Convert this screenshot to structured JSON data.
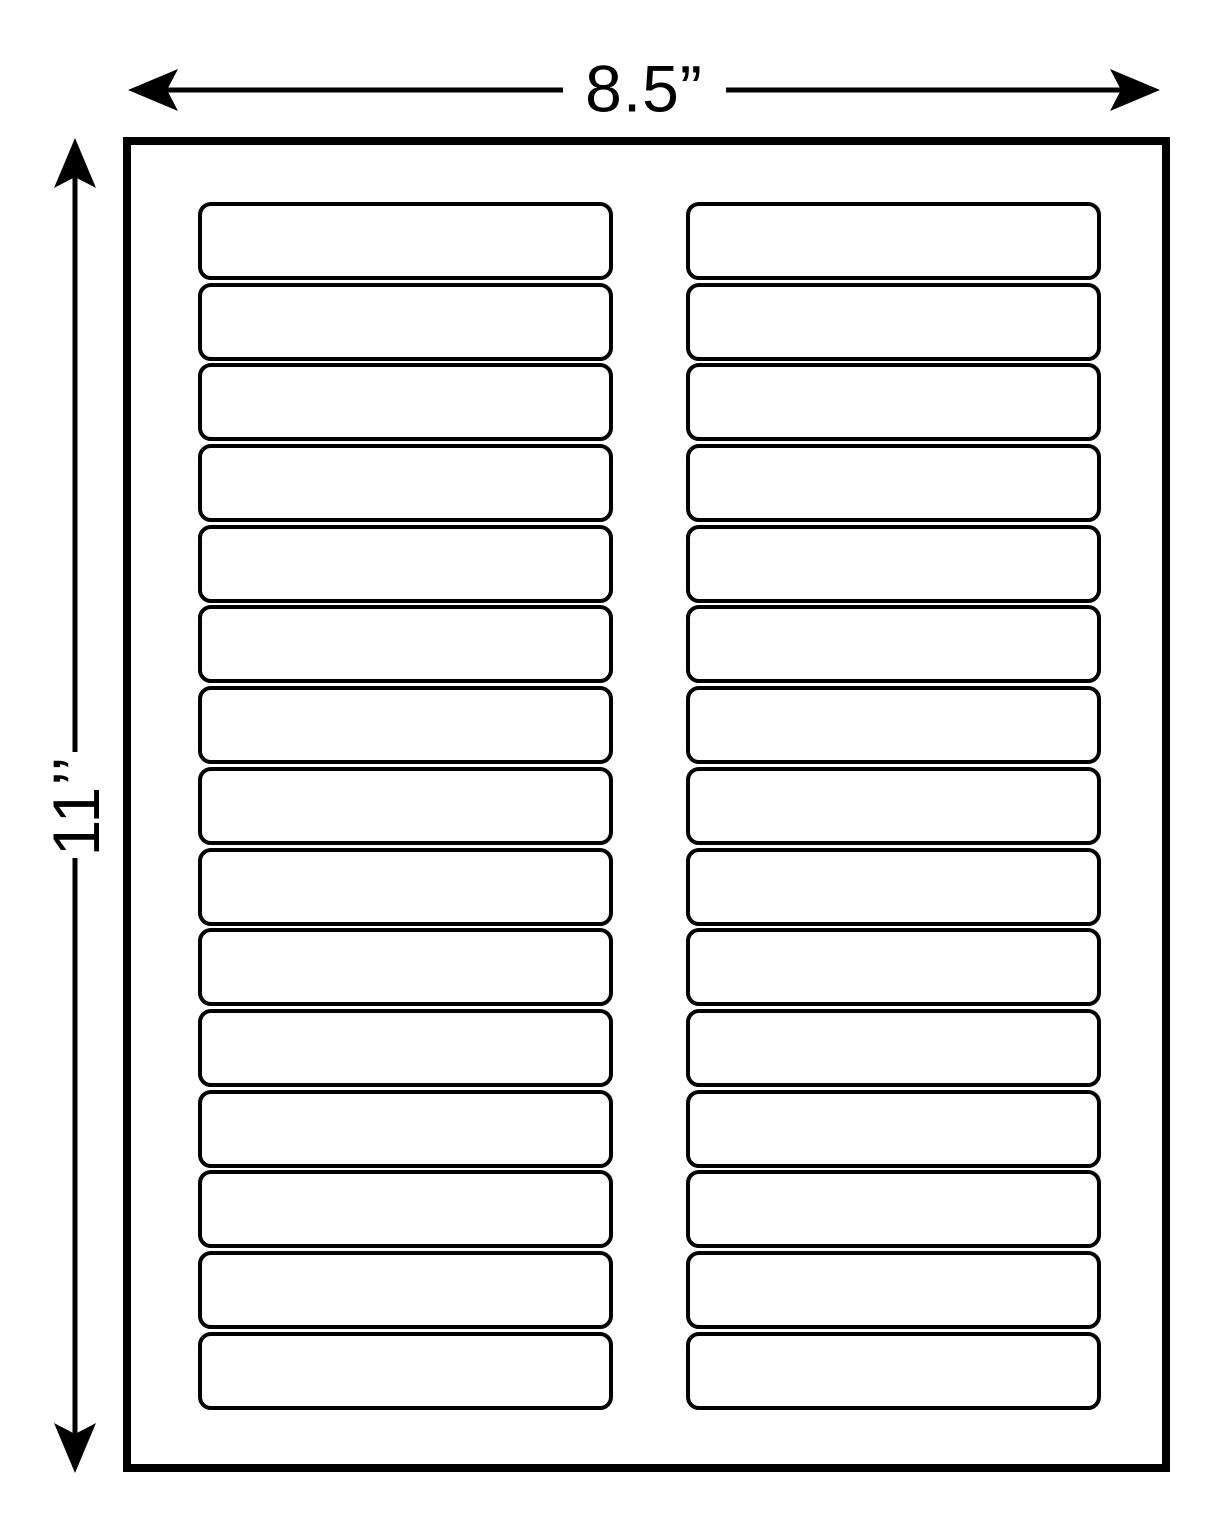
{
  "dimensions": {
    "width_label": "8.5”",
    "height_label": "11’’"
  },
  "sheet": {
    "rows": 15,
    "columns": 2,
    "total_labels": 30
  },
  "colors": {
    "line": "#000000",
    "background": "#ffffff"
  }
}
